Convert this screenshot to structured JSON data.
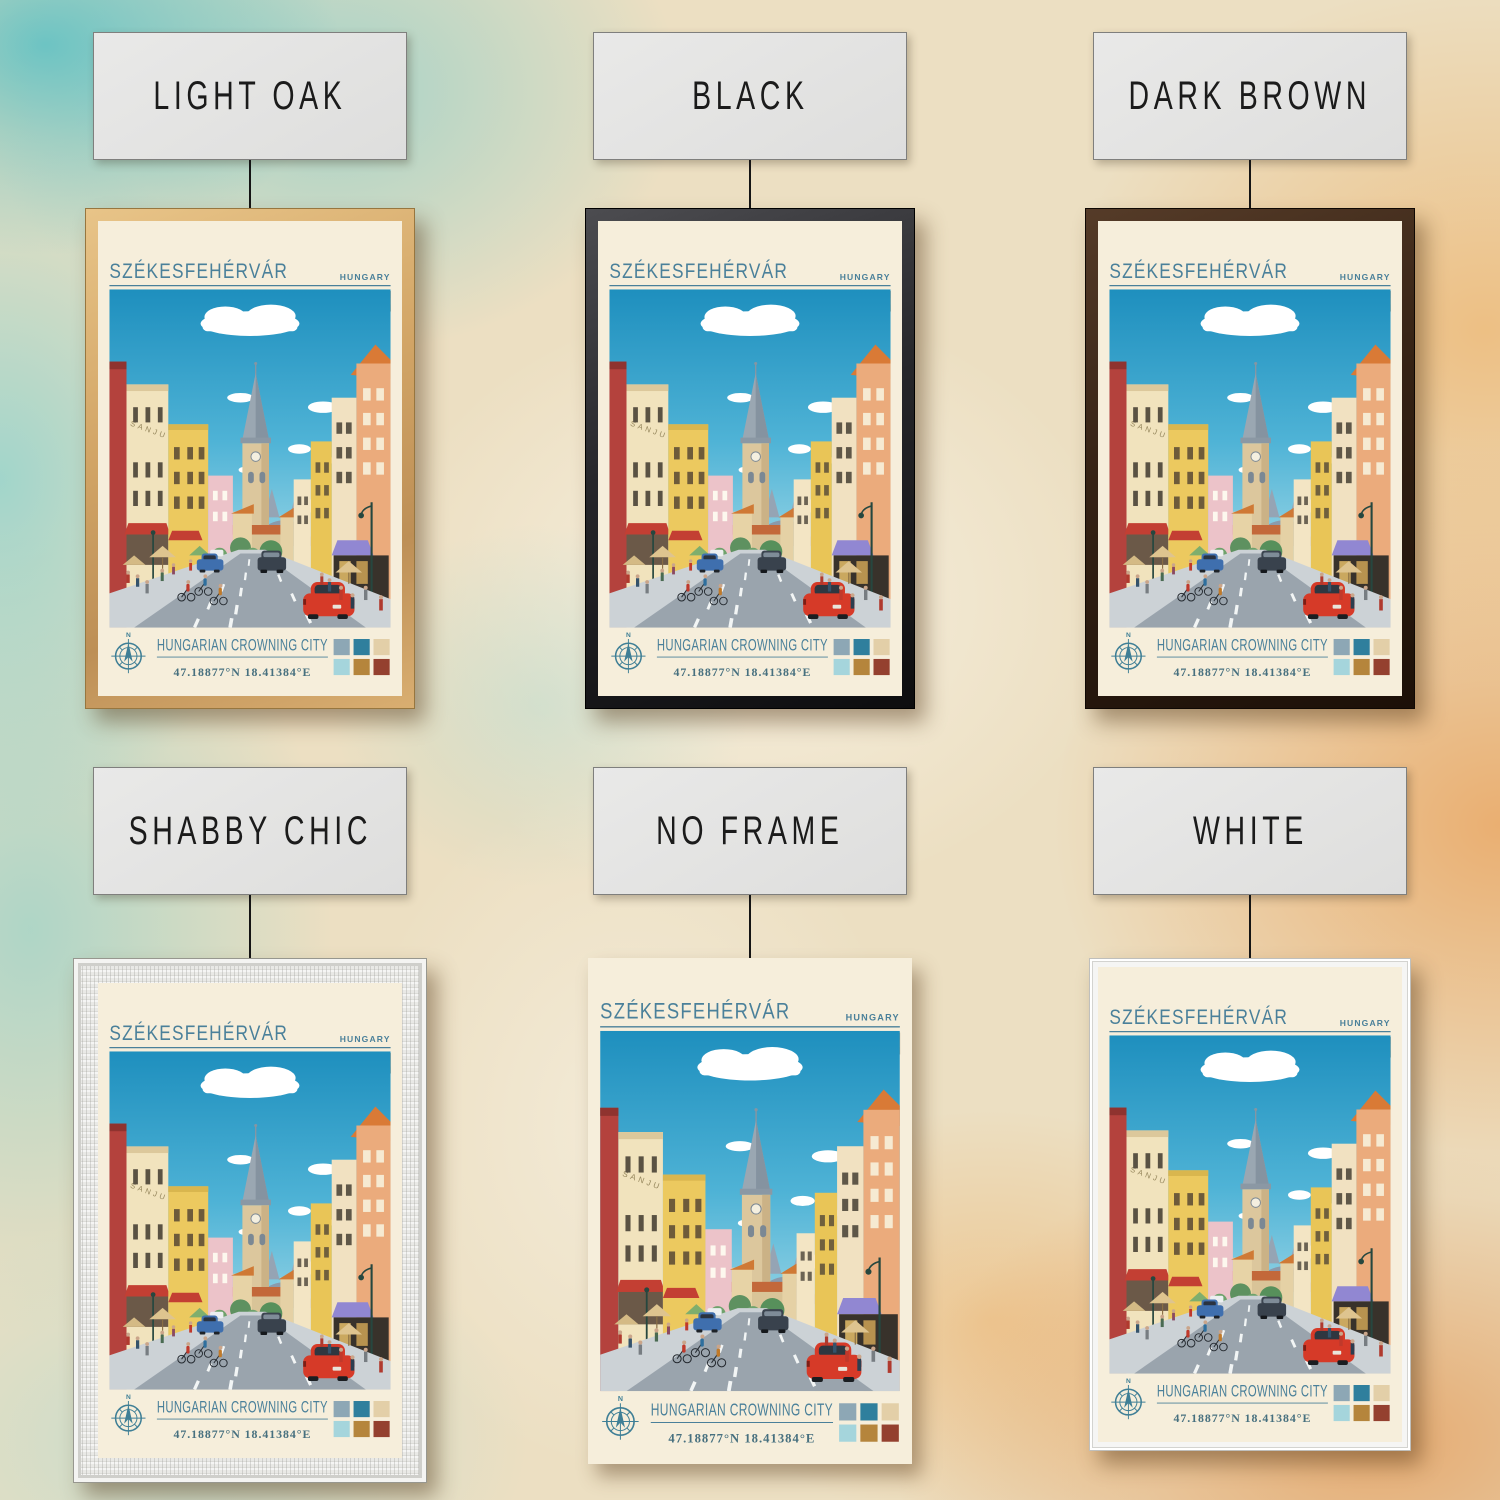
{
  "frames": [
    {
      "id": "light-oak",
      "label": "LIGHT OAK"
    },
    {
      "id": "black",
      "label": "BLACK"
    },
    {
      "id": "dark-brown",
      "label": "DARK BROWN"
    },
    {
      "id": "shabby-chic",
      "label": "SHABBY CHIC"
    },
    {
      "id": "no-frame",
      "label": "NO FRAME"
    },
    {
      "id": "white",
      "label": "WHITE"
    }
  ],
  "poster": {
    "city": "SZÉKESFEHÉRVÁR",
    "country": "HUNGARY",
    "tagline": "HUNGARIAN CROWNING CITY",
    "coordinates": "47.18877°N 18.41384°E",
    "compass_label": "N",
    "building_sign": "SANJU",
    "accent_color": "#4a809a",
    "flag_colors": [
      "#cf4a43",
      "#f4f0e4",
      "#3f7a4d"
    ],
    "palette_swatches": [
      "#8da7b5",
      "#2f7f9d",
      "#e3cfa8",
      "#a5d5dc",
      "#b5853c",
      "#94402f"
    ]
  }
}
